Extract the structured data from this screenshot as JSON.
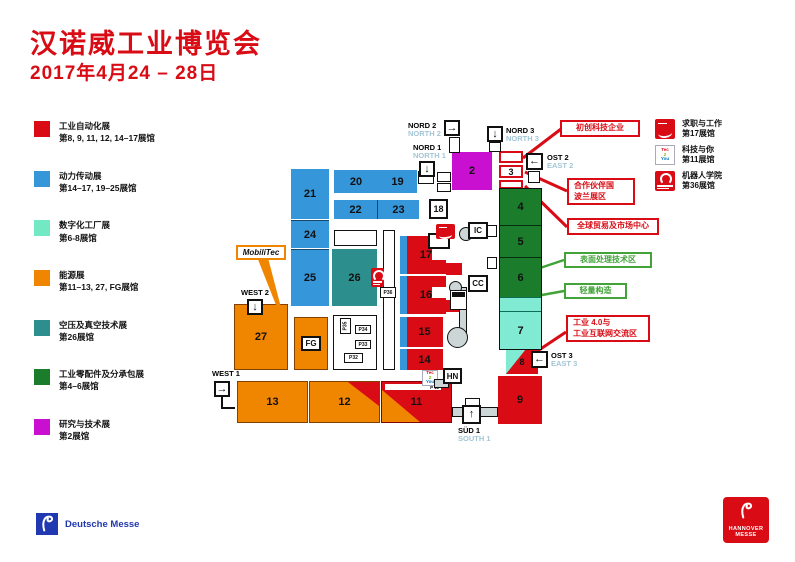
{
  "colors": {
    "brand_red": "#d90c15",
    "blue": "#3596d9",
    "mint": "#72e9c3",
    "orange": "#f08500",
    "teal": "#2d8e8e",
    "green": "#1b7c2c",
    "magenta": "#c90fd0",
    "aqua": "#80ead2",
    "callout_green": "#41a338",
    "walkway_gray": "#ccd6d6",
    "entrance_en_blue": "#a3c6d6",
    "deutsche_messe_blue": "#2038b0"
  },
  "header": {
    "title": "汉诺威工业博览会",
    "dates": "2017年4月24 – 28日"
  },
  "legend": [
    {
      "color": "#d90c15",
      "label": "工业自动化展",
      "halls": "第8, 9, 11, 12, 14–17展馆"
    },
    {
      "color": "#3596d9",
      "label": "动力传动展",
      "halls": "第14–17, 19–25展馆"
    },
    {
      "color": "#72e9c3",
      "label": "数字化工厂展",
      "halls": "第6-8展馆"
    },
    {
      "color": "#f08500",
      "label": "能源展",
      "halls": "第11–13, 27, FG展馆"
    },
    {
      "color": "#2d8e8e",
      "label": "空压及真空技术展",
      "halls": "第26展馆"
    },
    {
      "color": "#1b7c2c",
      "label": "工业零配件及分承包展",
      "halls": "第4–6展馆"
    },
    {
      "color": "#c90fd0",
      "label": "研究与技术展",
      "halls": "第2展馆"
    }
  ],
  "map": {
    "halls": {
      "h2": "2",
      "h3": "3",
      "h4": "4",
      "h5": "5",
      "h6": "6",
      "h7": "7",
      "h8": "8",
      "h9": "9",
      "h11": "11",
      "h12": "12",
      "h13": "13",
      "h14": "14",
      "h15": "15",
      "h16": "16",
      "h17": "17",
      "h18": "18",
      "h19": "19",
      "h20": "20",
      "h21": "21",
      "h22": "22",
      "h23": "23",
      "h24": "24",
      "h25": "25",
      "h26": "26",
      "h27": "27",
      "fg": "FG"
    },
    "markers": {
      "ic": "IC",
      "cc": "CC",
      "hn": "HN",
      "p11": "P 11",
      "p32": "P32",
      "p33": "P33",
      "p34": "P34",
      "p35": "P35",
      "p36": "P36"
    },
    "mobilitec": "MobiliTec",
    "entrances": {
      "nord1": {
        "de": "NORD 1",
        "en": "NORTH 1",
        "arrow": "↓"
      },
      "nord2": {
        "de": "NORD 2",
        "en": "NORTH 2",
        "arrow": "→"
      },
      "nord3": {
        "de": "NORD 3",
        "en": "NORTH 3",
        "arrow": "↓"
      },
      "ost2": {
        "de": "OST 2",
        "en": "EAST 2",
        "arrow": "←"
      },
      "ost3": {
        "de": "OST 3",
        "en": "EAST 3",
        "arrow": "←"
      },
      "west1": {
        "de": "WEST 1",
        "arrow": "→"
      },
      "west2": {
        "de": "WEST 2",
        "arrow": "↓"
      },
      "sued1": {
        "de": "SÜD 1",
        "en": "SOUTH 1",
        "arrow": "↑"
      }
    },
    "callouts": {
      "startups": {
        "line1": "初创科技企业"
      },
      "partner_country": {
        "line1": "合作伙伴国",
        "line2": "波兰展区"
      },
      "global_business": {
        "line1": "全球贸易及市场中心"
      },
      "surface_technology": {
        "line1": "表面处理技术区"
      },
      "lightweight_construction": {
        "line1": "轻量构造"
      },
      "industrie_4_0": {
        "line1": "工业 4.0与",
        "line2": "工业互联网交流区"
      }
    }
  },
  "features": [
    {
      "label": "求职与工作",
      "halls": "第17展馆"
    },
    {
      "label": "科技与你",
      "halls": "第11展馆",
      "icon_text": [
        "Tec",
        "2",
        "You"
      ]
    },
    {
      "label": "机器人学院",
      "halls": "第36展馆"
    }
  ],
  "footer": {
    "deutsche_messe": "Deutsche Messe",
    "hannover": "HANNOVER",
    "messe": "MESSE"
  }
}
